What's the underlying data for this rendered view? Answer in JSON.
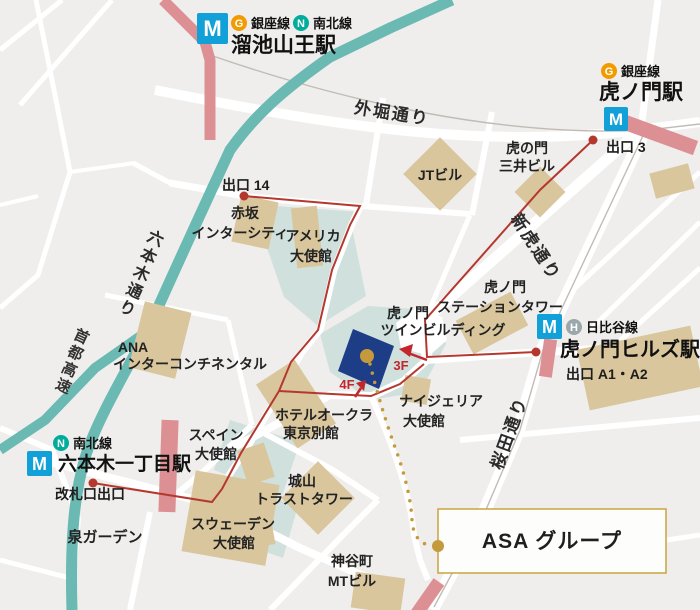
{
  "map": {
    "logo_letter": "M",
    "stations": {
      "tameike": {
        "name": "溜池山王駅",
        "line1_badge": "G",
        "line1": "銀座線",
        "line2_badge": "N",
        "line2": "南北線"
      },
      "toranomon": {
        "name": "虎ノ門駅",
        "line1_badge": "G",
        "line1": "銀座線",
        "exit": "出口 3"
      },
      "hills": {
        "name": "虎ノ門ヒルズ駅",
        "line1_badge": "H",
        "line1": "日比谷線",
        "exit": "出口 A1・A2"
      },
      "roppongi": {
        "name": "六本木一丁目駅",
        "line1_badge": "N",
        "line1": "南北線",
        "exit": "改札口出口"
      }
    },
    "exit14": "出口 14",
    "roads": {
      "sotobori": "外堀通り",
      "shintora": "新虎通り",
      "sakurada": "桜田通り",
      "roppongi_dori": "六本木通り",
      "shuto": "首都高速"
    },
    "floors": {
      "f3": "3F",
      "f4": "4F"
    },
    "places": {
      "jt": "JTビル",
      "mitsui1": "虎の門",
      "mitsui2": "三井ビル",
      "akasaka1": "赤坂",
      "akasaka2": "インターシティ",
      "america1": "アメリカ",
      "america2": "大使館",
      "ana1": "ANA",
      "ana2": "インターコンチネンタル",
      "twin1": "虎ノ門",
      "twin2": "ツインビルディング",
      "sttower1": "虎ノ門",
      "sttower2": "ステーションタワー",
      "nigeria1": "ナイジェリア",
      "nigeria2": "大使館",
      "okura1": "ホテルオークラ",
      "okura2": "東京別館",
      "spain1": "スペイン",
      "spain2": "大使館",
      "sweden1": "スウェーデン",
      "sweden2": "大使館",
      "shiroyama1": "城山",
      "shiroyama2": "トラストタワー",
      "izumi": "泉ガーデン",
      "kamiyacho1": "神谷町",
      "kamiyacho2": "MTビル"
    },
    "destination": "ASA グループ",
    "colors": {
      "background": "#efeeec",
      "road_white": "#ffffff",
      "road_teal": "#6ab9b2",
      "road_pink": "#dd9094",
      "building_tan": "#d9c69c",
      "area_pale": "#cfe0dd",
      "target_navy": "#1d3d87",
      "route_red": "#b5382f",
      "accent_gold": "#c49a3c",
      "metro_blue": "#12a0d8",
      "ginza_orange": "#f29b00",
      "namboku_teal": "#00ac9b",
      "hibiya_silver": "#9aa8ab"
    }
  }
}
